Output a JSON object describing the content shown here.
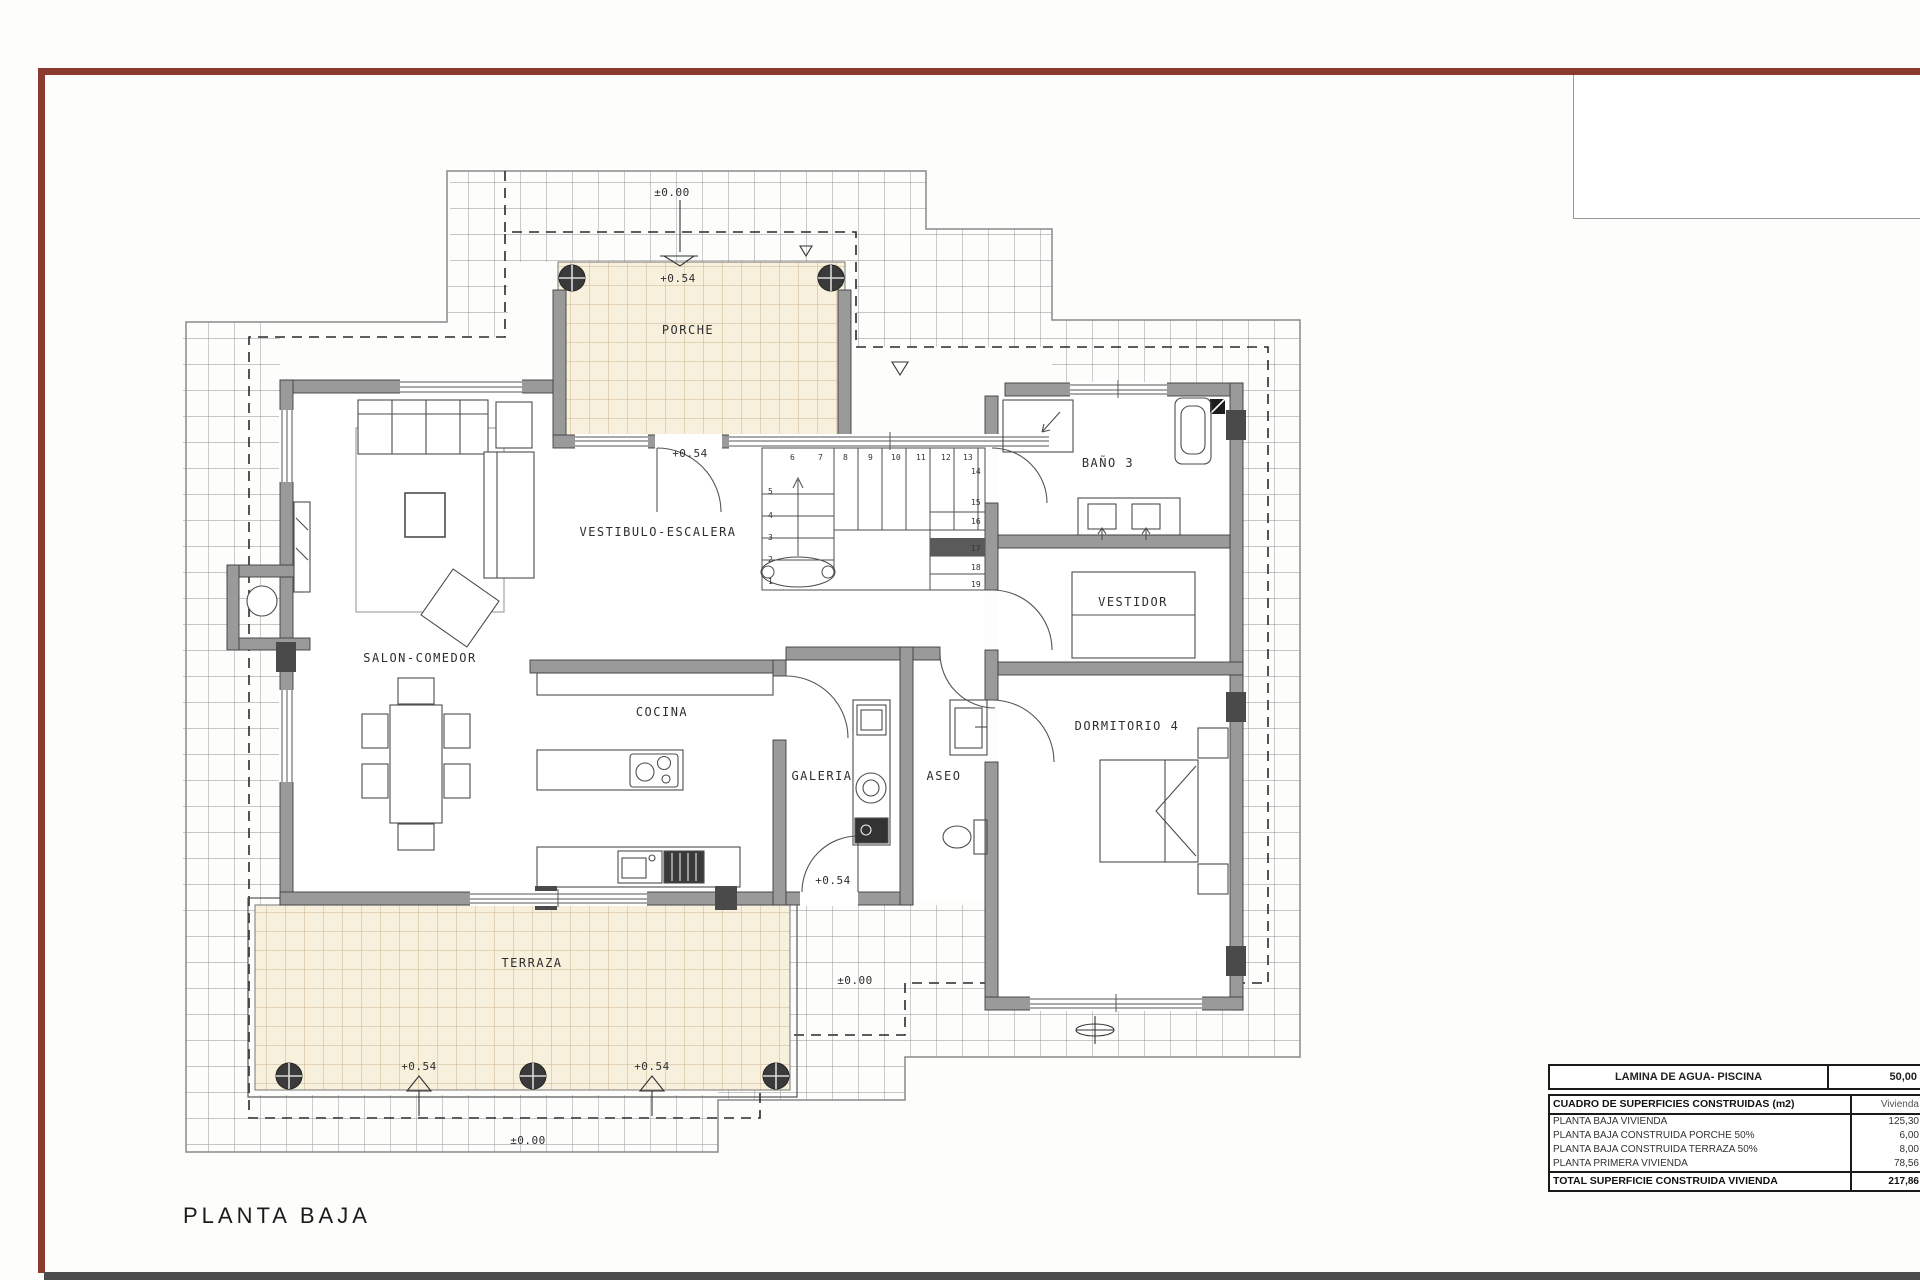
{
  "page": {
    "title": "PLANTA BAJA"
  },
  "rooms": {
    "porche": "PORCHE",
    "vestibulo": "VESTIBULO-ESCALERA",
    "salon": "SALON-COMEDOR",
    "cocina": "COCINA",
    "galeria": "GALERIA",
    "aseo": "ASEO",
    "bano3": "BAÑO 3",
    "vestidor": "VESTIDOR",
    "dormitorio4": "DORMITORIO 4",
    "terraza": "TERRAZA"
  },
  "levels": {
    "zero": "±0.00",
    "plus": "+0.54"
  },
  "stairs": {
    "n": [
      "1",
      "2",
      "3",
      "4",
      "5",
      "6",
      "7",
      "8",
      "9",
      "10",
      "11",
      "12",
      "13",
      "14",
      "15",
      "16",
      "17",
      "18",
      "19"
    ]
  },
  "tables": {
    "piscina": {
      "label": "LAMINA DE AGUA- PISCINA",
      "value": "50,00"
    },
    "surfaces": {
      "header": {
        "label": "CUADRO DE SUPERFICIES CONSTRUIDAS (m2)",
        "value": "Vivienda"
      },
      "rows": [
        {
          "label": "PLANTA BAJA VIVIENDA",
          "value": "125,30"
        },
        {
          "label": "PLANTA BAJA CONSTRUIDA PORCHE 50%",
          "value": "6,00"
        },
        {
          "label": "PLANTA BAJA CONSTRUIDA TERRAZA 50%",
          "value": "8,00"
        },
        {
          "label": "PLANTA PRIMERA VIVIENDA",
          "value": "78,56"
        }
      ],
      "total": {
        "label": "TOTAL SUPERFICIE CONSTRUIDA VIVIENDA",
        "value": "217,86"
      }
    }
  },
  "colors": {
    "frame_red": "#8a3a2e",
    "wall_gray": "#9a9a9a",
    "tile_beige": "#f7f0dd",
    "footer_bar": "#4c4c4c"
  }
}
